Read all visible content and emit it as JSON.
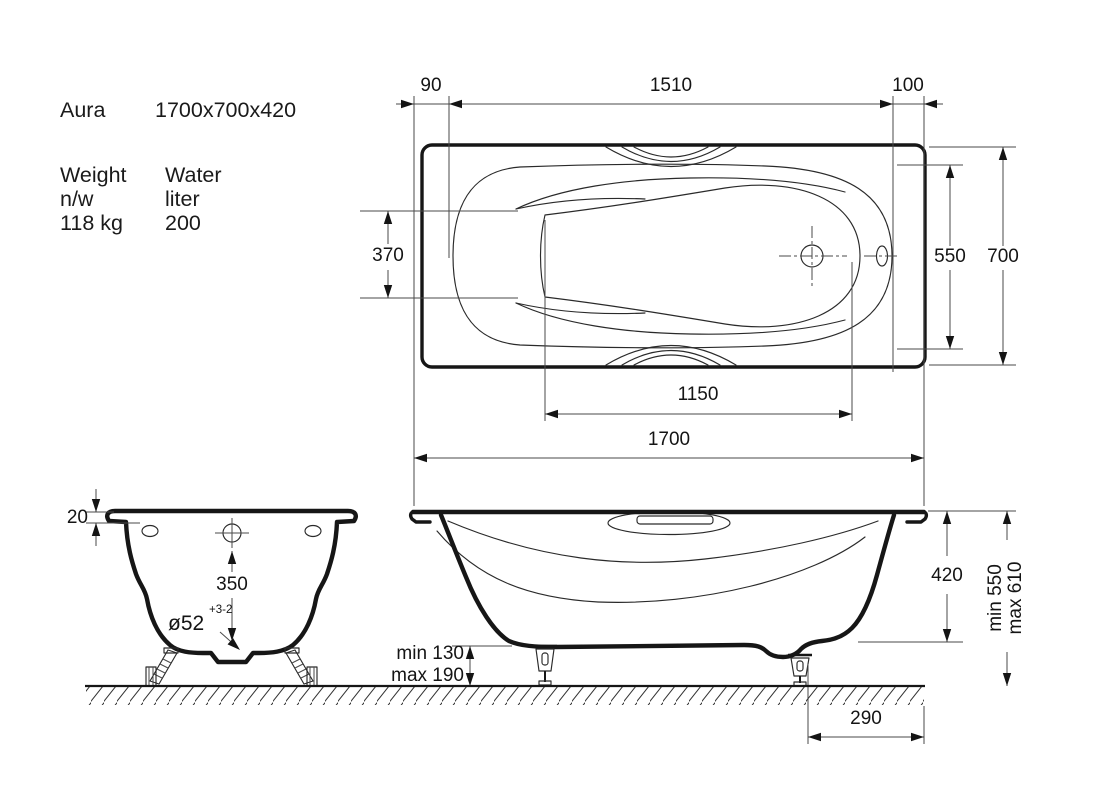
{
  "info": {
    "model": "Aura",
    "dimensions": "1700x700x420",
    "weight": {
      "label": "Weight",
      "unit": "n/w",
      "value": "118 kg"
    },
    "water": {
      "label": "Water",
      "unit": "liter",
      "value": "200"
    }
  },
  "dims": {
    "top": {
      "offset_left": "90",
      "rim_length": "1510",
      "offset_right": "100",
      "width_foot_end": "370",
      "width_back_end": "550",
      "overall_width": "700",
      "basin_length": "1150"
    },
    "side": {
      "overall_length": "1700",
      "shell_depth": "420",
      "height_min": "min 550",
      "height_max": "max 610",
      "feet_min": "min 130",
      "feet_max": "max 190",
      "drain_offset": "290"
    },
    "end": {
      "rim_height": "20",
      "drain_depth": "350",
      "drain_diameter": "ø52",
      "drain_tolerance": "+3-2"
    }
  },
  "colors": {
    "line": "#161616",
    "background": "#ffffff"
  }
}
